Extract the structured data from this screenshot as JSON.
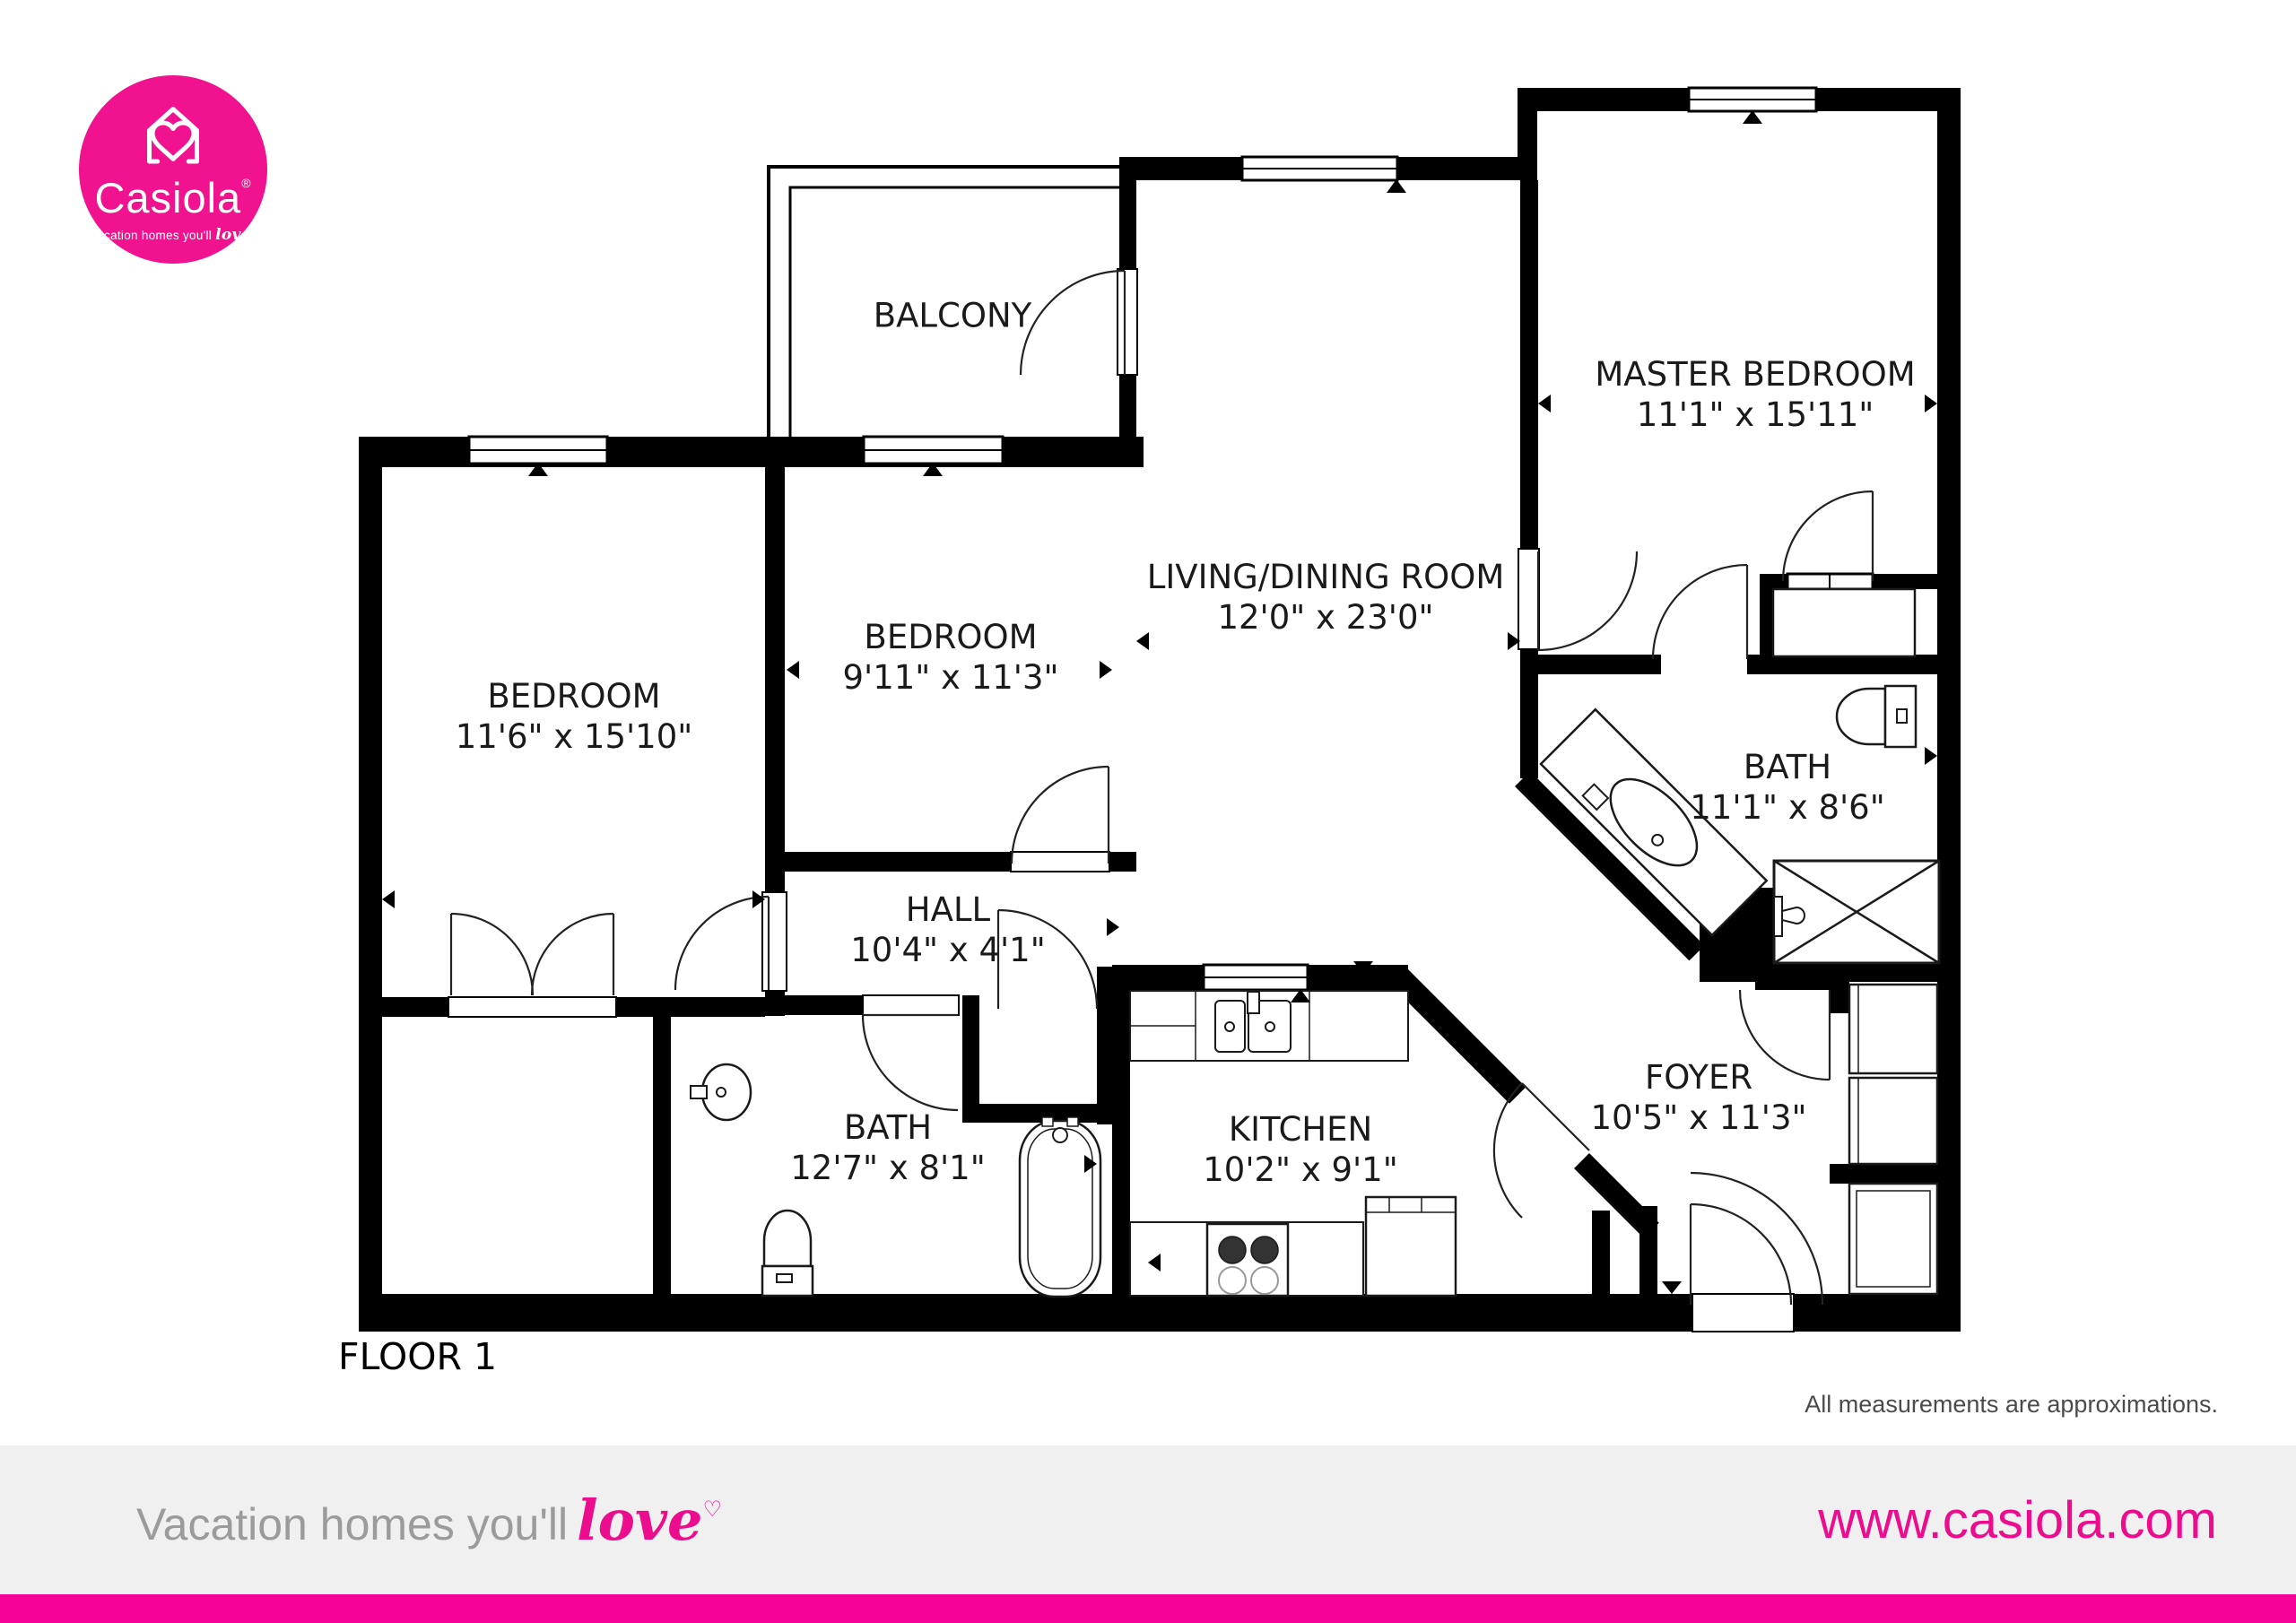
{
  "logo": {
    "brand": "Casiola",
    "registered_mark": "®",
    "tagline": "Vacation homes you'll",
    "tagline_accent": "love"
  },
  "floor_plan": {
    "floor_label": "FLOOR 1",
    "disclaimer": "All measurements are approximations.",
    "rooms": [
      {
        "id": "balcony",
        "name": "BALCONY",
        "dims": ""
      },
      {
        "id": "bedroom-left",
        "name": "BEDROOM",
        "dims": "11'6\" x 15'10\""
      },
      {
        "id": "bedroom-middle",
        "name": "BEDROOM",
        "dims": "9'11\" x 11'3\""
      },
      {
        "id": "living-dining",
        "name": "LIVING/DINING ROOM",
        "dims": "12'0\" x 23'0\""
      },
      {
        "id": "master-bedroom",
        "name": "MASTER BEDROOM",
        "dims": "11'1\" x 15'11\""
      },
      {
        "id": "bath-right",
        "name": "BATH",
        "dims": "11'1\" x 8'6\""
      },
      {
        "id": "hall",
        "name": "HALL",
        "dims": "10'4\" x 4'1\""
      },
      {
        "id": "bath-bottom",
        "name": "BATH",
        "dims": "12'7\" x 8'1\""
      },
      {
        "id": "kitchen",
        "name": "KITCHEN",
        "dims": "10'2\" x 9'1\""
      },
      {
        "id": "foyer",
        "name": "FOYER",
        "dims": "10'5\" x 11'3\""
      }
    ]
  },
  "footer": {
    "tagline": "Vacation homes you'll",
    "tagline_accent": "love",
    "heart": "♡",
    "website": "www.casiola.com"
  },
  "colors": {
    "brand_pink": "#F0128E",
    "footer_bar_pink": "#F7019B",
    "website_pink": "#EC0C8E",
    "tagline_gray": "#9B9B9B",
    "disclaimer_gray": "#4B4B4B",
    "footer_band_gray": "#F0F0F0",
    "wall_black": "#000000"
  }
}
